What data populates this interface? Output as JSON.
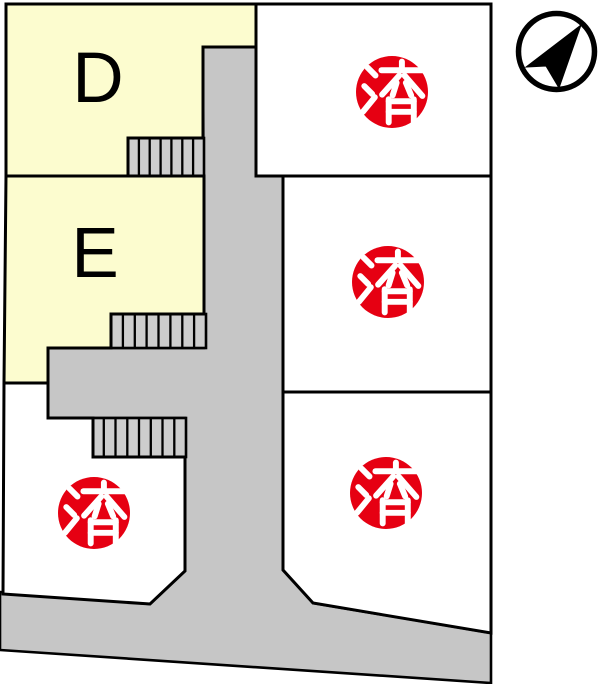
{
  "map": {
    "lots": [
      {
        "id": "lot-d",
        "label": "D"
      },
      {
        "id": "lot-e",
        "label": "E"
      },
      {
        "id": "lot-top-right",
        "badge": "済"
      },
      {
        "id": "lot-middle-right",
        "badge": "済"
      },
      {
        "id": "lot-bottom-right",
        "badge": "済"
      },
      {
        "id": "lot-bottom-left",
        "badge": "済"
      }
    ],
    "colors": {
      "available_fill": "#FCFCCF",
      "road_fill": "#C6C6C6",
      "stair_fill": "#CDCDCD",
      "sold_badge_fill": "#E60012",
      "sold_badge_text": "#FFFFFF",
      "outline": "#000000",
      "background": "#FFFFFF"
    }
  }
}
